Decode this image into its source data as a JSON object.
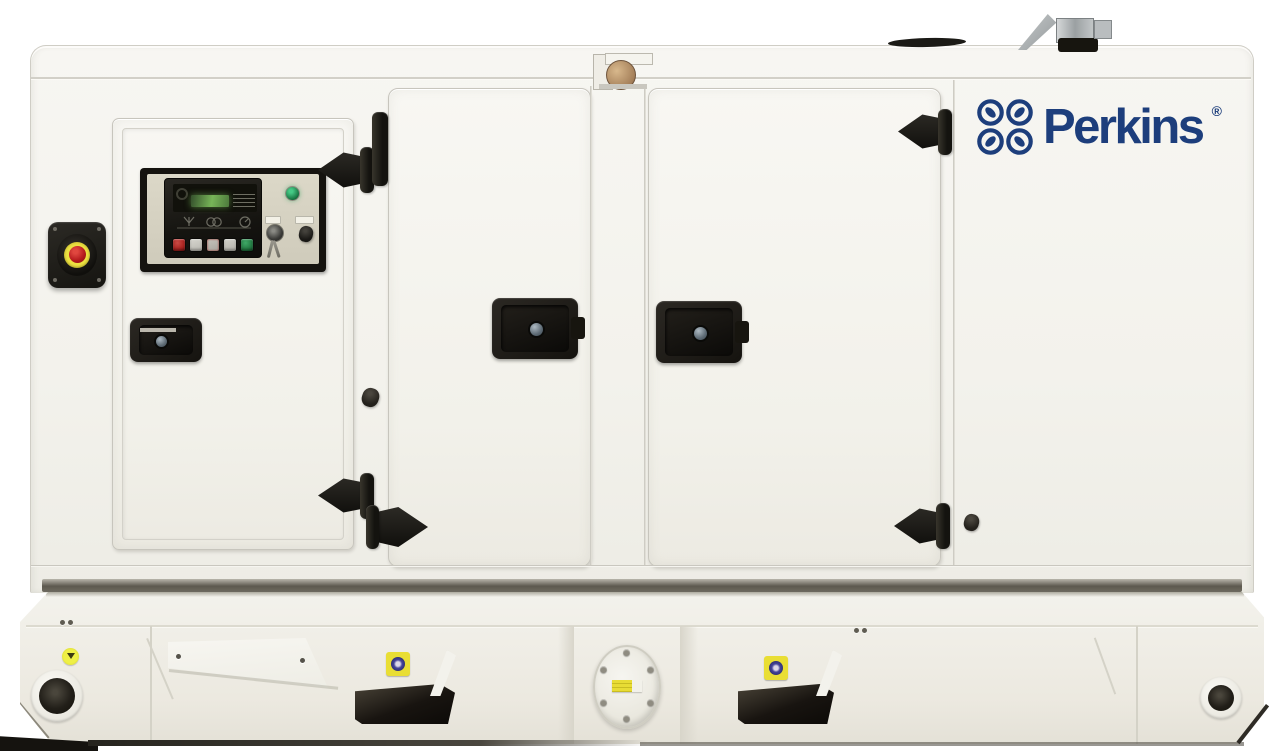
{
  "scene": {
    "description": "Perkins diesel generator set in a white soundproof canopy enclosure on a white fuel-tank base frame, photographed front-on against a white background",
    "background_color": "#ffffff"
  },
  "brand": {
    "wordmark": "Perkins",
    "registered_mark": "®",
    "logo_color": "#1d3e7c",
    "emblem": "four-interlocked-rings-with-leaves"
  },
  "colors": {
    "canopy_white": "#f4f3ee",
    "base_white": "#efeee7",
    "hardware_black": "#1d1b17",
    "seam_grey": "#c9c7bf",
    "estop_ring_yellow": "#e4d93f",
    "estop_button_red": "#b3191c",
    "indicator_lamp_green": "#1f7a45",
    "controller_lcd_green": "#77b558",
    "sticker_yellow": "#e9de34",
    "sticker_emblem_blue": "#45459a",
    "exhaust_metal_grey": "#aab0b2"
  },
  "canopy": {
    "panels": [
      "control-access-door",
      "service-door-left",
      "service-door-right",
      "right-end-panel"
    ],
    "hardware": [
      "strap-hinges",
      "recessed-latch-handles",
      "rubber-bumpers"
    ],
    "roof_features": [
      "lifting-bracket",
      "exhaust-rain-cap",
      "exhaust-outlet-elbow"
    ]
  },
  "control_panel": {
    "controller": {
      "display": "green-lcd-readout",
      "buttons": [
        {
          "name": "stop-button",
          "color": "#a82320"
        },
        {
          "name": "menu-button-1",
          "color": "#c9c8c1"
        },
        {
          "name": "alarm-button",
          "color": "#b3b1a9"
        },
        {
          "name": "menu-button-2",
          "color": "#c9c8c1"
        },
        {
          "name": "start-button",
          "color": "#237a42"
        }
      ]
    },
    "indicator_lamp": "green",
    "switches": [
      "key-switch-with-keys",
      "black-rotary-knob"
    ],
    "emergency_stop": {
      "housing": "black",
      "ring": "yellow",
      "button": "red"
    }
  },
  "base_frame": {
    "features": [
      "lifting-hole-left",
      "lifting-point-sticker",
      "forklift-pocket-left",
      "fuel-flange-access-plate",
      "forklift-pocket-right",
      "lifting-hole-right"
    ],
    "warning_stickers": 3
  }
}
